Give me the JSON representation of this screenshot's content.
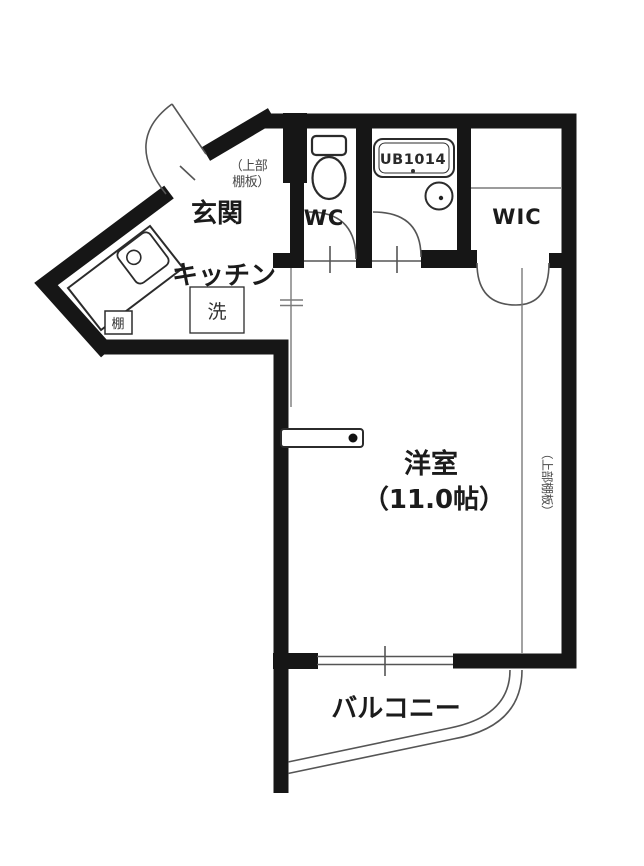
{
  "floorplan": {
    "rooms": {
      "entrance": {
        "label": "玄関"
      },
      "kitchen": {
        "label": "キッチン"
      },
      "wc": {
        "label": "WC"
      },
      "unit_bath": {
        "label": "UB1014"
      },
      "wic": {
        "label": "WIC"
      },
      "living": {
        "label": "洋室",
        "size": "（11.0帖）"
      },
      "balcony": {
        "label": "バルコニー"
      }
    },
    "fixtures": {
      "washer": {
        "label": "洗"
      },
      "shelf": {
        "label": "棚"
      }
    },
    "notes": {
      "entrance_upper_shelf": {
        "line1": "（上部",
        "line2": "棚板）"
      },
      "room_upper_shelf": {
        "label": "（上部棚板）"
      }
    },
    "colors": {
      "wall": "#161616",
      "fixture_line": "#2b2b2b",
      "door_line": "#555555",
      "divider_line": "#7a7a7a",
      "note_text": "#4a4a4a",
      "background": "#ffffff"
    }
  }
}
